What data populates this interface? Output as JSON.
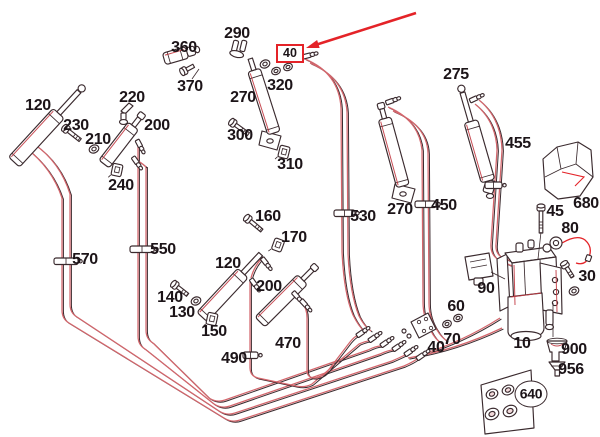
{
  "diagram": {
    "type": "exploded-hydraulic-parts-diagram",
    "canvas": {
      "width": 600,
      "height": 437,
      "background": "#ffffff"
    },
    "colors": {
      "ink": "#3a2a2e",
      "red": "#c23a42",
      "hose": "#d4666c",
      "hl": "#e42328",
      "text": "#1c1418",
      "tint": "#f3dadb"
    },
    "highlight": {
      "label": "40",
      "box": {
        "left": 276,
        "top": 44,
        "width": 24,
        "height": 15
      },
      "arrow": {
        "x1": 416,
        "y1": 13,
        "x2": 306,
        "y2": 48
      }
    },
    "labels": [
      {
        "text": "360",
        "x": 184,
        "y": 48
      },
      {
        "text": "370",
        "x": 190,
        "y": 87
      },
      {
        "text": "290",
        "x": 237,
        "y": 34
      },
      {
        "text": "270",
        "x": 243,
        "y": 98
      },
      {
        "text": "320",
        "x": 280,
        "y": 86
      },
      {
        "text": "300",
        "x": 240,
        "y": 136
      },
      {
        "text": "310",
        "x": 290,
        "y": 165
      },
      {
        "text": "120",
        "x": 38,
        "y": 106
      },
      {
        "text": "230",
        "x": 76,
        "y": 126
      },
      {
        "text": "210",
        "x": 98,
        "y": 140
      },
      {
        "text": "220",
        "x": 132,
        "y": 98
      },
      {
        "text": "200",
        "x": 157,
        "y": 126
      },
      {
        "text": "240",
        "x": 121,
        "y": 186
      },
      {
        "text": "275",
        "x": 456,
        "y": 75
      },
      {
        "text": "455",
        "x": 518,
        "y": 144
      },
      {
        "text": "680",
        "x": 586,
        "y": 204
      },
      {
        "text": "45",
        "x": 555,
        "y": 212
      },
      {
        "text": "80",
        "x": 570,
        "y": 229
      },
      {
        "text": "30",
        "x": 587,
        "y": 277
      },
      {
        "text": "530",
        "x": 363,
        "y": 217
      },
      {
        "text": "270",
        "x": 400,
        "y": 210
      },
      {
        "text": "450",
        "x": 444,
        "y": 206
      },
      {
        "text": "570",
        "x": 85,
        "y": 260
      },
      {
        "text": "550",
        "x": 163,
        "y": 250
      },
      {
        "text": "160",
        "x": 268,
        "y": 217
      },
      {
        "text": "170",
        "x": 294,
        "y": 238
      },
      {
        "text": "120",
        "x": 228,
        "y": 264
      },
      {
        "text": "200",
        "x": 269,
        "y": 287
      },
      {
        "text": "140",
        "x": 170,
        "y": 298
      },
      {
        "text": "130",
        "x": 182,
        "y": 313
      },
      {
        "text": "150",
        "x": 214,
        "y": 332
      },
      {
        "text": "490",
        "x": 234,
        "y": 359
      },
      {
        "text": "470",
        "x": 288,
        "y": 344
      },
      {
        "text": "90",
        "x": 486,
        "y": 289
      },
      {
        "text": "60",
        "x": 456,
        "y": 307
      },
      {
        "text": "70",
        "x": 452,
        "y": 340
      },
      {
        "text": "40",
        "x": 436,
        "y": 348
      },
      {
        "text": "10",
        "x": 522,
        "y": 344
      },
      {
        "text": "900",
        "x": 574,
        "y": 350
      },
      {
        "text": "956",
        "x": 571,
        "y": 370
      },
      {
        "text": "640",
        "x": 531,
        "y": 394,
        "circled": true
      }
    ],
    "leaders": [
      [
        192,
        79,
        199,
        69
      ],
      [
        541,
        232,
        538,
        259
      ],
      [
        491,
        272,
        505,
        279
      ],
      [
        553,
        303,
        553,
        337
      ]
    ],
    "hoses": [
      {
        "name": "hose-570-a",
        "d": "M26,148 Q52,168 62,198 L62,310 Q62,319 69,323 L224,418 Q232,423 240,420 L404,366 Q413,362 417,359"
      },
      {
        "name": "hose-570-b",
        "d": "M34,144 Q60,162 70,194 L70,304 Q70,313 77,317 L219,411 Q227,416 235,413 L392,361 Q401,357 405,355"
      },
      {
        "name": "hose-550-a",
        "d": "M138,142 L138,336 Q138,345 145,349 L214,404 Q222,409 230,406 L380,354 Q389,350 393,350"
      },
      {
        "name": "hose-550-b",
        "d": "M146,166 L146,330 Q146,339 153,343 L209,398 Q217,403 225,400 L368,350 Q376,346 381,346"
      },
      {
        "name": "hose-490",
        "d": "M250,282 L250,368 Q250,376 258,378 L296,386 Q305,388 312,384 L359,344 Q366,341 369,341"
      },
      {
        "name": "hose-470",
        "d": "M302,303 Q307,308 307,318 L307,370 Q307,378 315,378 Q322,377 327,372 L350,342 Q355,336 357,336"
      },
      {
        "name": "hose-530-a",
        "d": "M305,59 Q339,73 341,108 L342,252 Q344,294 353,315 Q359,327 365,332"
      },
      {
        "name": "hose-530-b",
        "d": "M310,63 Q345,78 347,112 L348,254 Q350,294 359,316 Q364,326 371,331"
      },
      {
        "name": "hose-450-a",
        "d": "M388,107 Q419,120 422,150 L423,302 Q423,318 431,331 Q435,339 441,343"
      },
      {
        "name": "hose-450-b",
        "d": "M393,111 Q427,125 428,153 L429,303 Q429,318 437,330 Q441,337 447,341"
      },
      {
        "name": "hose-455-a",
        "d": "M475,104 Q496,121 497,150 L491,243 Q490,255 499,260 L512,266"
      },
      {
        "name": "hose-455-b",
        "d": "M479,100 Q501,118 502,150 L496,244 Q495,254 503,258 L514,262"
      },
      {
        "name": "hose-pump-in-1",
        "d": "M420,355 Q462,342 500,318"
      },
      {
        "name": "hose-pump-in-2",
        "d": "M408,358 Q456,350 502,328"
      },
      {
        "name": "hose-stub-550-b",
        "d": "M134,159 Q141,162 146,167"
      },
      {
        "name": "hose-stub-490",
        "d": "M263,257 Q254,266 251,278"
      },
      {
        "name": "hose-stub-470",
        "d": "M291,295 Q299,298 302,303"
      }
    ],
    "parts": {
      "cylinders": [
        {
          "name": "cylinder-120-upper-left",
          "x": 14,
          "y": 162,
          "angle": -47.4,
          "len": 66,
          "w": 15,
          "rod": 30,
          "rw": 5,
          "ring": true
        },
        {
          "name": "cylinder-200-upper",
          "x": 104,
          "y": 164,
          "angle": -52.3,
          "len": 48,
          "w": 13,
          "rod": 10,
          "rw": 4.5,
          "tip": true
        },
        {
          "name": "cylinder-270-upper-middle",
          "x": 274,
          "y": 133,
          "angle": -107.7,
          "len": 66,
          "w": 13,
          "rod": 12,
          "rw": 4.5
        },
        {
          "name": "cylinder-270-right",
          "x": 403,
          "y": 186,
          "angle": -105.3,
          "len": 70,
          "w": 13,
          "rod": 10,
          "rw": 4.5,
          "tip": true
        },
        {
          "name": "cylinder-275",
          "x": 488,
          "y": 181,
          "angle": -106.1,
          "len": 62,
          "w": 14,
          "rod": 30,
          "rw": 5,
          "ring": true
        },
        {
          "name": "cylinder-120-lower",
          "x": 202,
          "y": 317,
          "angle": -47,
          "len": 60,
          "w": 14,
          "rod": 26,
          "rw": 5
        },
        {
          "name": "cylinder-200-lower",
          "x": 260,
          "y": 322,
          "angle": -45,
          "len": 60,
          "w": 14,
          "rod": 14,
          "rw": 4.5,
          "tip": true
        }
      ],
      "bolts": [
        {
          "name": "bolt-230",
          "x": 66,
          "y": 129,
          "a": 38,
          "len": 15
        },
        {
          "name": "bolt-300",
          "x": 233,
          "y": 123,
          "a": 36,
          "len": 16
        },
        {
          "name": "bolt-160",
          "x": 248,
          "y": 219,
          "a": 40,
          "len": 15
        },
        {
          "name": "bolt-140",
          "x": 175,
          "y": 285,
          "a": 38,
          "len": 13
        },
        {
          "name": "bolt-370",
          "x": 184,
          "y": 71,
          "a": -28,
          "len": 8
        },
        {
          "name": "bolt-45",
          "x": 541,
          "y": 208,
          "a": 90,
          "len": 22
        },
        {
          "name": "pin-30",
          "x": 565,
          "y": 265,
          "a": 58,
          "len": 11
        }
      ],
      "washers": [
        {
          "name": "washer-210",
          "x": 94,
          "y": 149,
          "r": 5
        },
        {
          "name": "washer-130",
          "x": 196,
          "y": 301,
          "r": 5
        },
        {
          "name": "washer-320-a",
          "x": 265,
          "y": 64,
          "r": 5
        },
        {
          "name": "washer-320-b",
          "x": 276,
          "y": 71,
          "r": 4.5
        },
        {
          "name": "washer-40",
          "x": 288,
          "y": 67,
          "r": 4.5
        },
        {
          "name": "washer-60-a",
          "x": 447,
          "y": 324,
          "r": 4.5
        },
        {
          "name": "washer-60-b",
          "x": 458,
          "y": 318,
          "r": 4.5
        },
        {
          "name": "ring-30",
          "x": 574,
          "y": 291,
          "r": 5
        },
        {
          "name": "grommet-640-1",
          "x": 492,
          "y": 394,
          "r": 6,
          "grm": true
        },
        {
          "name": "grommet-640-2",
          "x": 508,
          "y": 390,
          "r": 6,
          "grm": true
        },
        {
          "name": "grommet-640-3",
          "x": 492,
          "y": 414,
          "r": 7,
          "grm": true
        },
        {
          "name": "grommet-640-4",
          "x": 510,
          "y": 411,
          "r": 7,
          "grm": true
        }
      ],
      "clips": [
        {
          "name": "clip-240",
          "x": 117,
          "y": 170,
          "a": 12
        },
        {
          "name": "clip-310",
          "x": 284,
          "y": 152,
          "a": 14
        },
        {
          "name": "clip-150",
          "x": 212,
          "y": 319,
          "a": 12
        },
        {
          "name": "rod-end-170",
          "x": 278,
          "y": 245,
          "a": 20
        }
      ],
      "clamps": [
        {
          "name": "hose-clamp-570",
          "x": 54,
          "y": 258,
          "w": 24
        },
        {
          "name": "hose-clamp-550",
          "x": 130,
          "y": 246,
          "w": 24
        },
        {
          "name": "hose-clamp-530",
          "x": 334,
          "y": 210,
          "w": 21
        },
        {
          "name": "hose-clamp-450",
          "x": 415,
          "y": 201,
          "w": 21
        },
        {
          "name": "hose-clamp-490",
          "x": 243,
          "y": 352,
          "w": 15
        },
        {
          "name": "hose-clamp-455",
          "x": 485,
          "y": 182,
          "w": 17
        }
      ],
      "fittings": [
        {
          "name": "union-fitting-1",
          "x": 357,
          "y": 336,
          "a": -35
        },
        {
          "name": "union-fitting-2",
          "x": 369,
          "y": 341,
          "a": -35
        },
        {
          "name": "union-fitting-3",
          "x": 381,
          "y": 346,
          "a": -35
        },
        {
          "name": "union-fitting-4",
          "x": 393,
          "y": 350,
          "a": -35
        },
        {
          "name": "union-fitting-5",
          "x": 405,
          "y": 355,
          "a": -35
        },
        {
          "name": "union-fitting-6",
          "x": 417,
          "y": 359,
          "a": -35
        },
        {
          "name": "banjo-fitting-40",
          "x": 303,
          "y": 57,
          "a": -15
        },
        {
          "name": "banjo-fitting-455",
          "x": 470,
          "y": 101,
          "a": -25
        },
        {
          "name": "fitting-550-a",
          "x": 137,
          "y": 140,
          "a": 62
        },
        {
          "name": "fitting-550-b",
          "x": 133,
          "y": 157,
          "a": 55
        },
        {
          "name": "banjo-fitting-490",
          "x": 251,
          "y": 279,
          "a": 55
        },
        {
          "name": "banjo-fitting-470-a",
          "x": 293,
          "y": 292,
          "a": 48
        },
        {
          "name": "banjo-fitting-470-b",
          "x": 301,
          "y": 300,
          "a": 48
        },
        {
          "name": "banjo-fitting-450",
          "x": 386,
          "y": 103,
          "a": -20
        },
        {
          "name": "rod-banjo-120",
          "x": 262,
          "y": 258,
          "a": 52
        }
      ]
    }
  }
}
